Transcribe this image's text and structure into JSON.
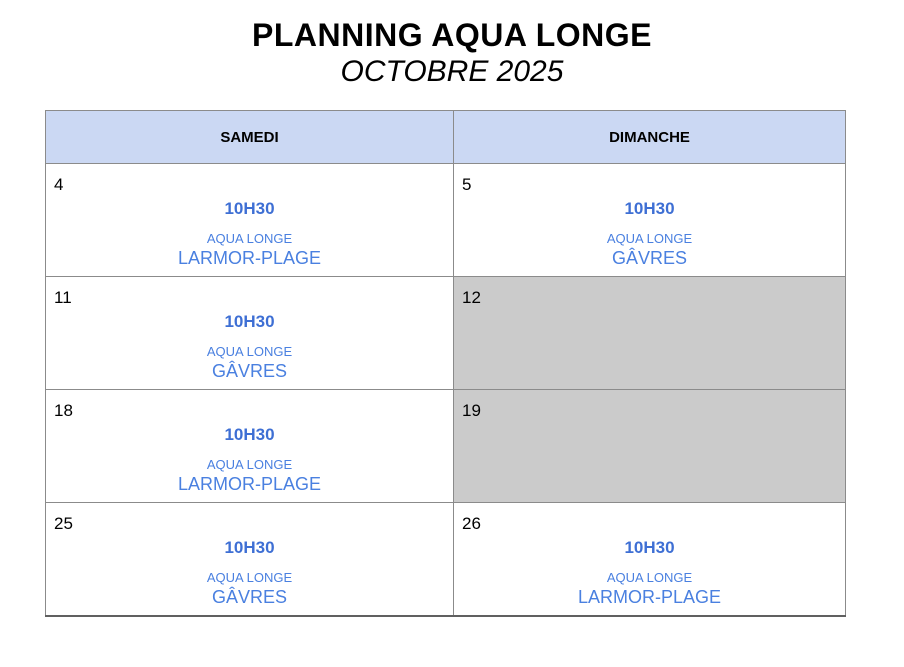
{
  "title": "PLANNING AQUA LONGE",
  "subtitle": "OCTOBRE 2025",
  "colors": {
    "header_bg": "#cbd8f3",
    "unavailable_bg": "#cbcbcb",
    "session_time_text": "#3e6fd4",
    "session_text": "#4a80e0",
    "border": "#8b8b8b"
  },
  "table": {
    "headers": [
      "SAMEDI",
      "DIMANCHE"
    ],
    "rows": [
      [
        {
          "day": "4",
          "time": "10H30",
          "activity": "AQUA LONGE",
          "location": "LARMOR-PLAGE",
          "unavailable": false
        },
        {
          "day": "5",
          "time": "10H30",
          "activity": "AQUA LONGE",
          "location": "GÂVRES",
          "unavailable": false
        }
      ],
      [
        {
          "day": "11",
          "time": "10H30",
          "activity": "AQUA LONGE",
          "location": "GÂVRES",
          "unavailable": false
        },
        {
          "day": "12",
          "unavailable": true
        }
      ],
      [
        {
          "day": "18",
          "time": "10H30",
          "activity": "AQUA LONGE",
          "location": "LARMOR-PLAGE",
          "unavailable": false
        },
        {
          "day": "19",
          "unavailable": true
        }
      ],
      [
        {
          "day": "25",
          "time": "10H30",
          "activity": "AQUA LONGE",
          "location": "GÂVRES",
          "unavailable": false
        },
        {
          "day": "26",
          "time": "10H30",
          "activity": "AQUA LONGE",
          "location": "LARMOR-PLAGE",
          "unavailable": false
        }
      ]
    ]
  }
}
